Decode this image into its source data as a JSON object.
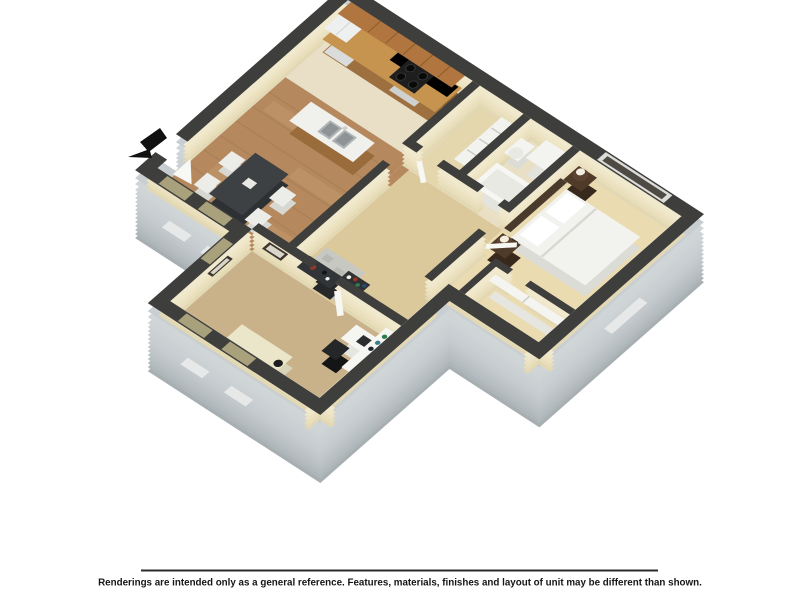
{
  "page": {
    "background": "#ffffff"
  },
  "floor_plan": {
    "kind": "3d-isometric-apartment-floor-plan",
    "entry_icon": "entry-arrow-icon",
    "rooms": [
      "kitchen",
      "dining area",
      "hallway",
      "laundry closet",
      "bathroom",
      "bedroom",
      "bedroom closet",
      "living area"
    ],
    "furnishings": [
      "upper wood cabinets",
      "refrigerator",
      "range with black cooktop",
      "kitchen island with double sink",
      "dark dining table with four white chairs",
      "gray area rug",
      "dark console table",
      "shelf rack with bottles",
      "bathtub",
      "toilet",
      "linen shelves",
      "bed with white bedding and pillows",
      "dark headboard",
      "two nightstands with lamps",
      "sliding closet panel",
      "white bookshelf hutch",
      "white desk with laptop",
      "black desk chair",
      "cream chaise lounge",
      "wall art frames"
    ],
    "colors": {
      "wall_cap": "#3e3e3c",
      "interior_wall_face": "#ece2c2",
      "exterior_wall": "#bfc5c8",
      "exterior_wall_dark": "#aeb6b9",
      "wood_floor": "#b5885e",
      "kitchen_tile": "#e8dfc6",
      "carpet_living": "#c9b189",
      "carpet_bedroom": "#ebdbb1",
      "hall_carpet": "#dbc99c",
      "cabinet_wood": "#b1763f",
      "window_sill": "#a9a07c",
      "furniture_white": "#f2f2ee",
      "accent_dark": "#2e3133",
      "entry_arrow": "#111111"
    }
  },
  "footer": {
    "disclaimer": "Renderings are intended only as a general reference. Features, materials, finishes and layout of unit may be different than shown."
  }
}
